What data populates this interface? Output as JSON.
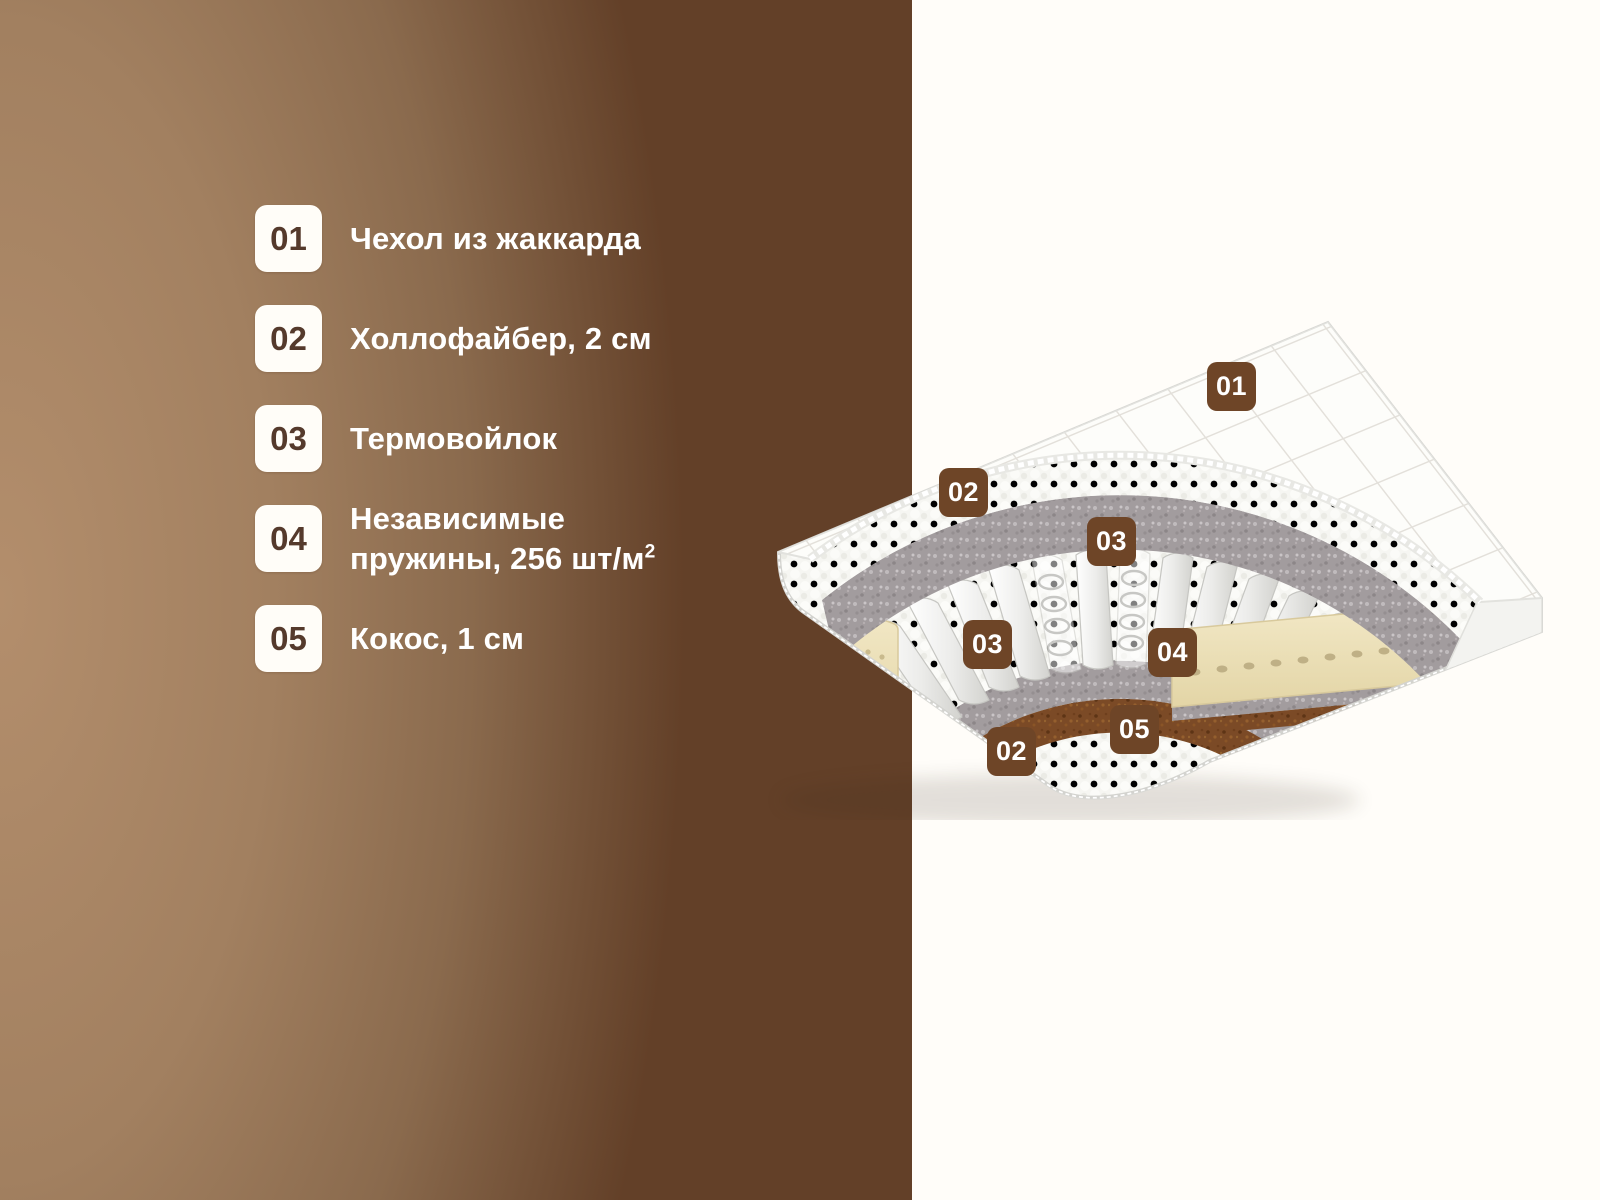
{
  "page": {
    "background_right": "#fffdf9"
  },
  "brand_panel": {
    "gradient_start": "#b38e6c",
    "gradient_end": "#634028",
    "width_px": 912
  },
  "legend": {
    "tile_bg": "#fffdf8",
    "tile_number_color": "#553a2c",
    "label_color": "#ffffff",
    "items": [
      {
        "number": "01",
        "label": "Чехол из жаккарда"
      },
      {
        "number": "02",
        "label": "Холлофайбер, 2 см"
      },
      {
        "number": "03",
        "label": "Термовойлок"
      },
      {
        "number": "04",
        "label_line1": "Независимые",
        "label_line2": "пружины, 256 шт/м",
        "label_superscript": "2"
      },
      {
        "number": "05",
        "label": "Кокос, 1 см"
      }
    ]
  },
  "mattress": {
    "badge_color": "#6e4527",
    "badge_text_color": "#ffffff",
    "badges": [
      {
        "number": "01",
        "x": 1207,
        "y": 362
      },
      {
        "number": "02",
        "x": 939,
        "y": 468
      },
      {
        "number": "03",
        "x": 1087,
        "y": 517
      },
      {
        "number": "03",
        "x": 963,
        "y": 620
      },
      {
        "number": "04",
        "x": 1148,
        "y": 628
      },
      {
        "number": "05",
        "x": 1110,
        "y": 705
      },
      {
        "number": "02",
        "x": 987,
        "y": 727
      }
    ],
    "layer_colors": {
      "quilt": "#fdfdfa",
      "fluff": "#f5f5f1",
      "felt": "#a29c9e",
      "coir": "#7b4a26",
      "latex": "#eee3bd"
    }
  }
}
